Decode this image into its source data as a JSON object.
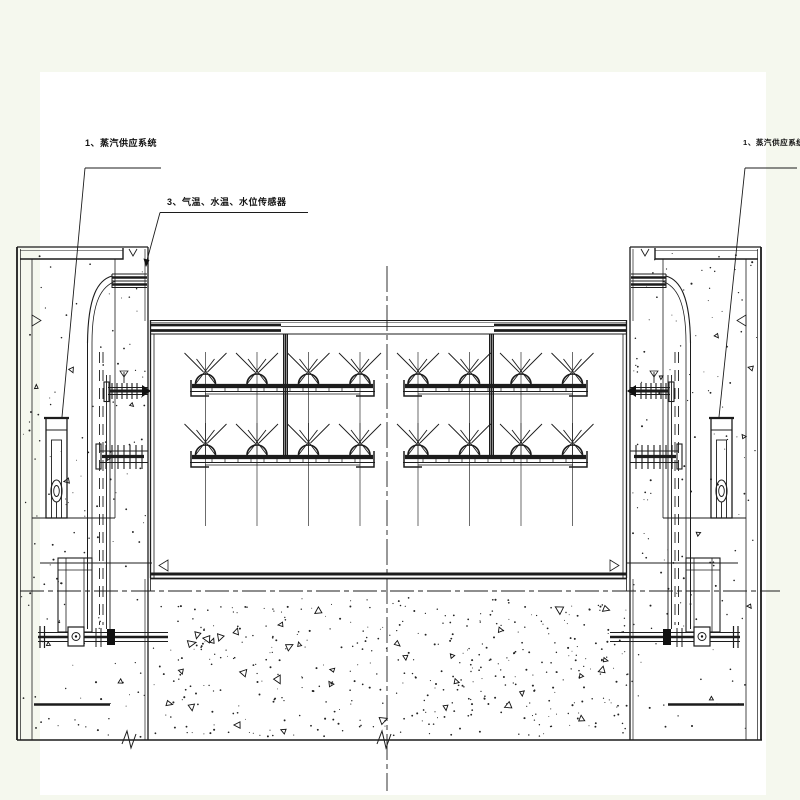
{
  "drawing": {
    "labels": {
      "steam_left": "1、蒸汽供应系统",
      "sensors": "3、气温、水温、水位传感器",
      "steam_right": "1、蒸汽供应系统"
    },
    "colors": {
      "background": "#f5f8ee",
      "paper": "#ffffff",
      "ink": "#1c1c1c"
    }
  }
}
